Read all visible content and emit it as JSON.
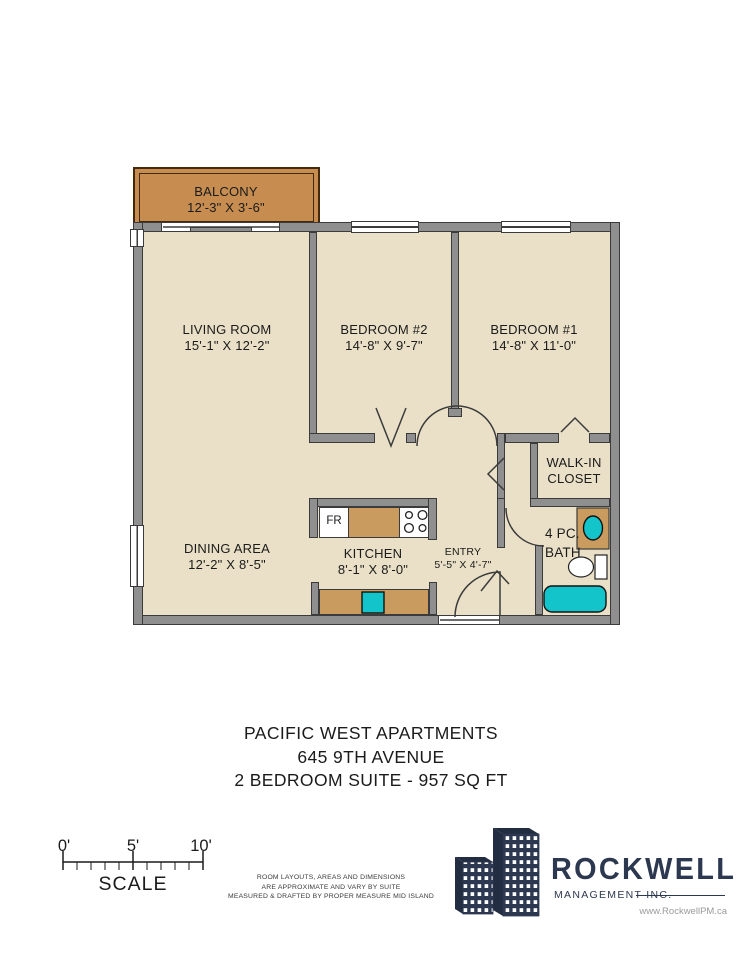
{
  "plan": {
    "rooms": {
      "balcony": {
        "name": "BALCONY",
        "dims": "12'-3\" X 3'-6\""
      },
      "living": {
        "name": "LIVING ROOM",
        "dims": "15'-1\" X 12'-2\""
      },
      "bedroom2": {
        "name": "BEDROOM #2",
        "dims": "14'-8\" X 9'-7\""
      },
      "bedroom1": {
        "name": "BEDROOM #1",
        "dims": "14'-8\" X 11'-0\""
      },
      "walkin": {
        "line1": "WALK-IN",
        "line2": "CLOSET"
      },
      "bath": {
        "line1": "4 PC.",
        "line2": "BATH"
      },
      "dining": {
        "name": "DINING AREA",
        "dims": "12'-2\" X 8'-5\""
      },
      "kitchen": {
        "name": "KITCHEN",
        "dims": "8'-1\" X 8'-0\""
      },
      "entry": {
        "name": "ENTRY",
        "dims": "5'-5\" X 4'-7\""
      }
    },
    "appliances": {
      "fridge": "FR"
    }
  },
  "title": {
    "line1": "PACIFIC WEST APARTMENTS",
    "line2": "645 9TH AVENUE",
    "line3": "2 BEDROOM SUITE - 957 SQ FT"
  },
  "scale": {
    "t0": "0'",
    "t5": "5'",
    "t10": "10'",
    "label": "SCALE"
  },
  "disclaimer": {
    "line1": "ROOM LAYOUTS, AREAS AND DIMENSIONS",
    "line2": "ARE APPROXIMATE AND VARY BY SUITE",
    "line3": "MEASURED & DRAFTED BY PROPER MEASURE MID ISLAND"
  },
  "logo": {
    "name": "ROCKWELL",
    "subtitle": "MANAGEMENT INC.",
    "website": "www.RockwellPM.ca"
  },
  "colors": {
    "floor": "#EAE0C7",
    "wall": "#8F8F8F",
    "wall_border": "#3b3b3b",
    "balcony": "#C68C50",
    "balcony_border": "#46290B",
    "counter": "#C99B5E",
    "teal": "#13C5CA",
    "navy": "#2C3850",
    "text": "#1B1B1B"
  }
}
